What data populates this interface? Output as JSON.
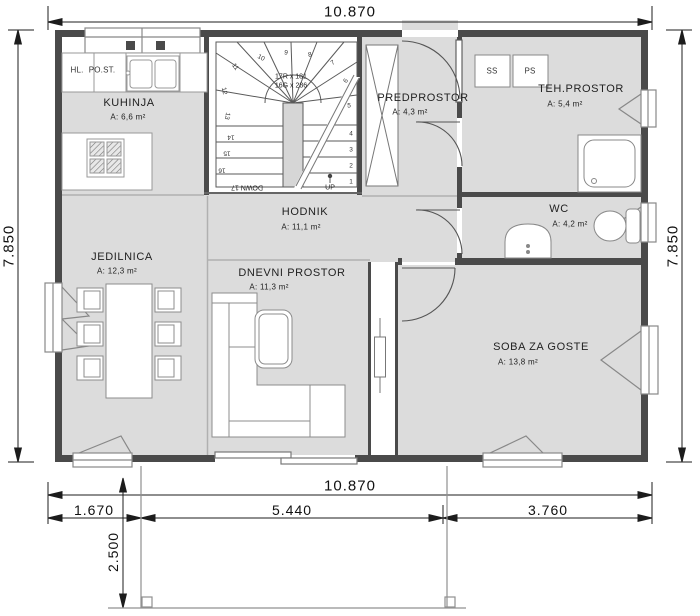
{
  "drawing": {
    "dims": {
      "top": "10.870",
      "left": "7.850",
      "right": "7.850",
      "bottom_total": "10.870",
      "bottom_seg1": "1.670",
      "bottom_seg2": "5.440",
      "bottom_seg3": "3.760",
      "terrace_depth": "2.500"
    },
    "rooms": [
      {
        "name": "KUHINJA",
        "area": "A: 6,6 m²"
      },
      {
        "name": "JEDILNICA",
        "area": "A: 12,3 m²"
      },
      {
        "name": "HODNIK",
        "area": "A: 11,1 m²"
      },
      {
        "name": "DNEVNI PROSTOR",
        "area": "A: 11,3 m²"
      },
      {
        "name": "PREDPROSTOR",
        "area": "A: 4,3 m²"
      },
      {
        "name": "TEH.PROSTOR",
        "area": "A: 5,4 m²"
      },
      {
        "name": "WC",
        "area": "A: 4,2 m²"
      },
      {
        "name": "SOBA ZA GOSTE",
        "area": "A: 13,8 m²"
      }
    ],
    "appliances": {
      "hl": "HL.",
      "post": "PO.ST.",
      "ss": "SS",
      "ps": "PS"
    },
    "stairs": {
      "spec1": "17R x 181",
      "spec2": "16G x 286",
      "up": "UP",
      "down": "DOWN 17",
      "steps": [
        "1",
        "2",
        "3",
        "4",
        "5",
        "6",
        "7",
        "8",
        "9",
        "10",
        "11",
        "12",
        "13",
        "14",
        "15",
        "16"
      ]
    },
    "colors": {
      "floor": "#dcdcdc",
      "wall": "#4a4a4a",
      "dimension": "#1c1c1c"
    }
  }
}
